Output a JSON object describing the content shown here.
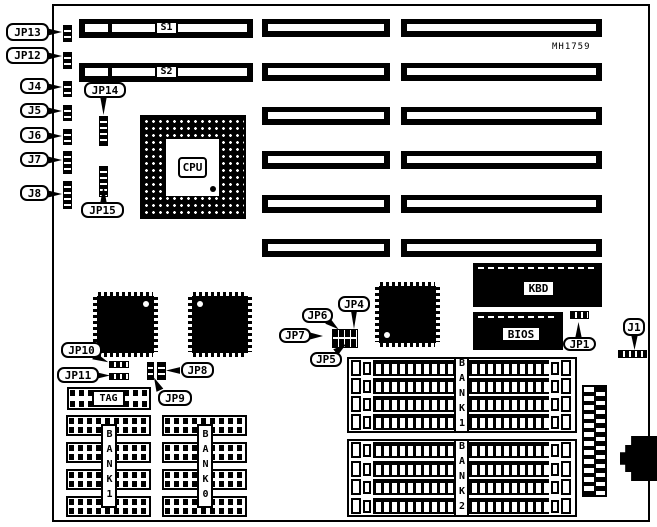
{
  "diagram": {
    "part_number": "MH1759",
    "cpu_label": "CPU",
    "slot_labels": {
      "s1": "S1",
      "s2": "S2"
    },
    "chip_labels": {
      "kbd": "KBD",
      "bios": "BIOS"
    },
    "tag_label": "TAG",
    "bank_labels": {
      "left_bank1": "BANK1",
      "left_bank0": "BANK0",
      "right_bank1": "BANK1",
      "right_bank2": "BANK2"
    },
    "callouts": {
      "jp13": "JP13",
      "jp12": "JP12",
      "j4": "J4",
      "j5": "J5",
      "j6": "J6",
      "j7": "J7",
      "j8": "J8",
      "jp14": "JP14",
      "jp15": "JP15",
      "jp10": "JP10",
      "jp11": "JP11",
      "jp8": "JP8",
      "jp9": "JP9",
      "jp6": "JP6",
      "jp4": "JP4",
      "jp7": "JP7",
      "jp5": "JP5",
      "jp1": "JP1",
      "j1": "J1"
    }
  }
}
